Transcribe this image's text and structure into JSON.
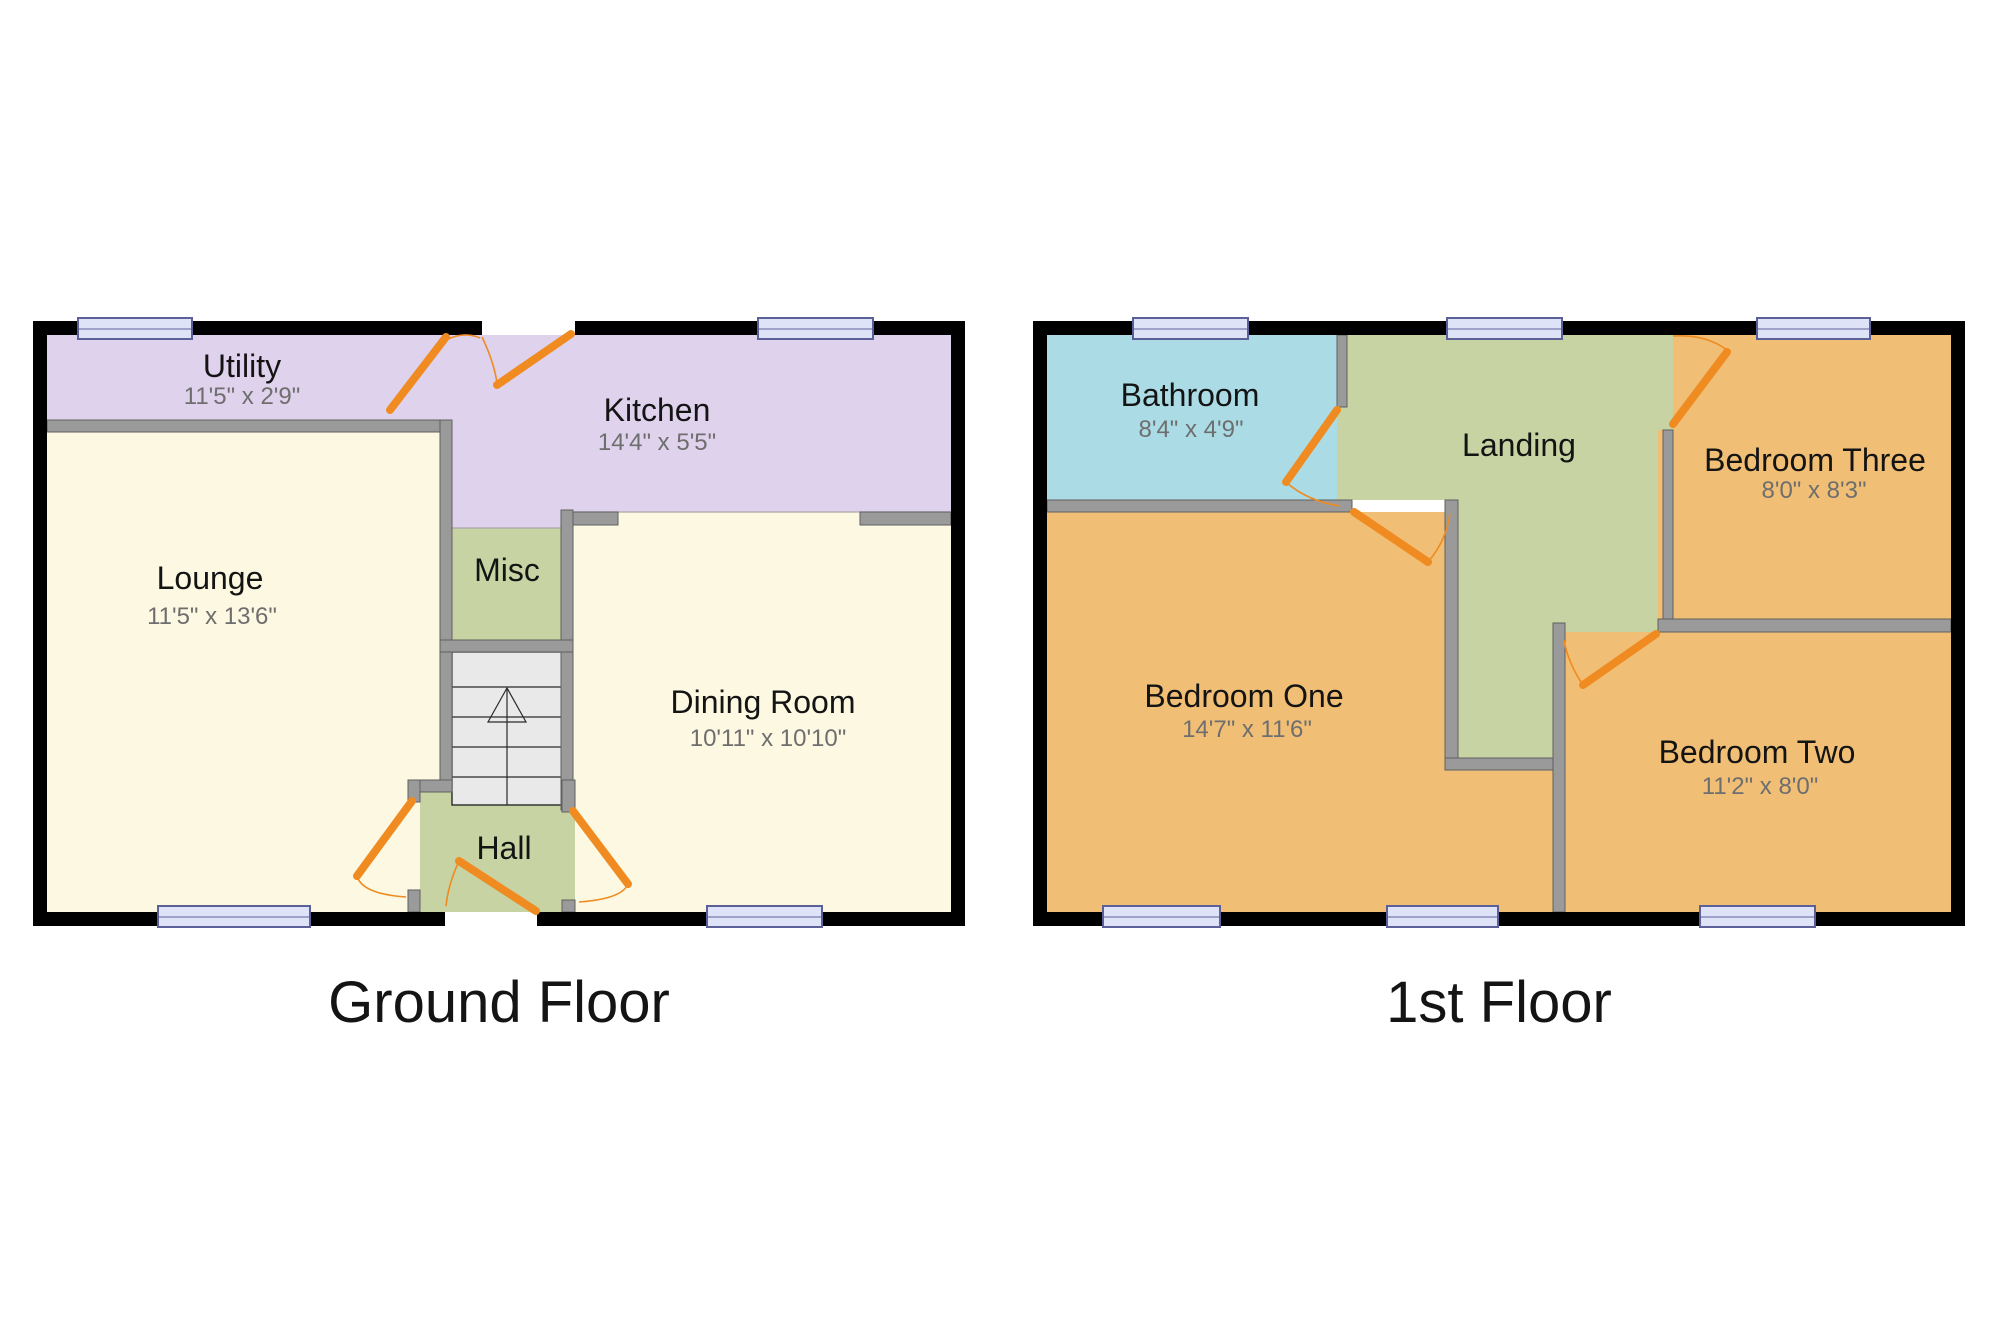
{
  "colors": {
    "outer_wall": "#000000",
    "inner_wall": "#9a9a9a",
    "wall_edge": "#606060",
    "door": "#EF8B20",
    "window_fill": "#dfe3f8",
    "window_border": "#5c6099",
    "stairs_fill": "#e9e9e9",
    "room_lavender": "#dfd2ec",
    "room_cream": "#fcf8e1",
    "room_green": "#c7d3a2",
    "room_blue": "#abdce5",
    "room_orange": "#f0bf75",
    "label_color": "#141414",
    "dims_color": "#6e6e6e"
  },
  "floors": [
    {
      "label": "Ground Floor",
      "rooms": {
        "utility": {
          "name": "Utility",
          "dims": "11'5\" x 2'9\""
        },
        "kitchen": {
          "name": "Kitchen",
          "dims": "14'4\" x 5'5\""
        },
        "lounge": {
          "name": "Lounge",
          "dims": "11'5\" x 13'6\""
        },
        "misc": {
          "name": "Misc"
        },
        "dining": {
          "name": "Dining Room",
          "dims": "10'11\" x 10'10\""
        },
        "hall": {
          "name": "Hall"
        }
      }
    },
    {
      "label": "1st Floor",
      "rooms": {
        "bathroom": {
          "name": "Bathroom",
          "dims": "8'4\" x 4'9\""
        },
        "landing": {
          "name": "Landing"
        },
        "bedroom_three": {
          "name": "Bedroom Three",
          "dims": "8'0\" x 8'3\""
        },
        "bedroom_one": {
          "name": "Bedroom One",
          "dims": "14'7\" x 11'6\""
        },
        "bedroom_two": {
          "name": "Bedroom Two",
          "dims": "11'2\" x 8'0\""
        }
      }
    }
  ]
}
